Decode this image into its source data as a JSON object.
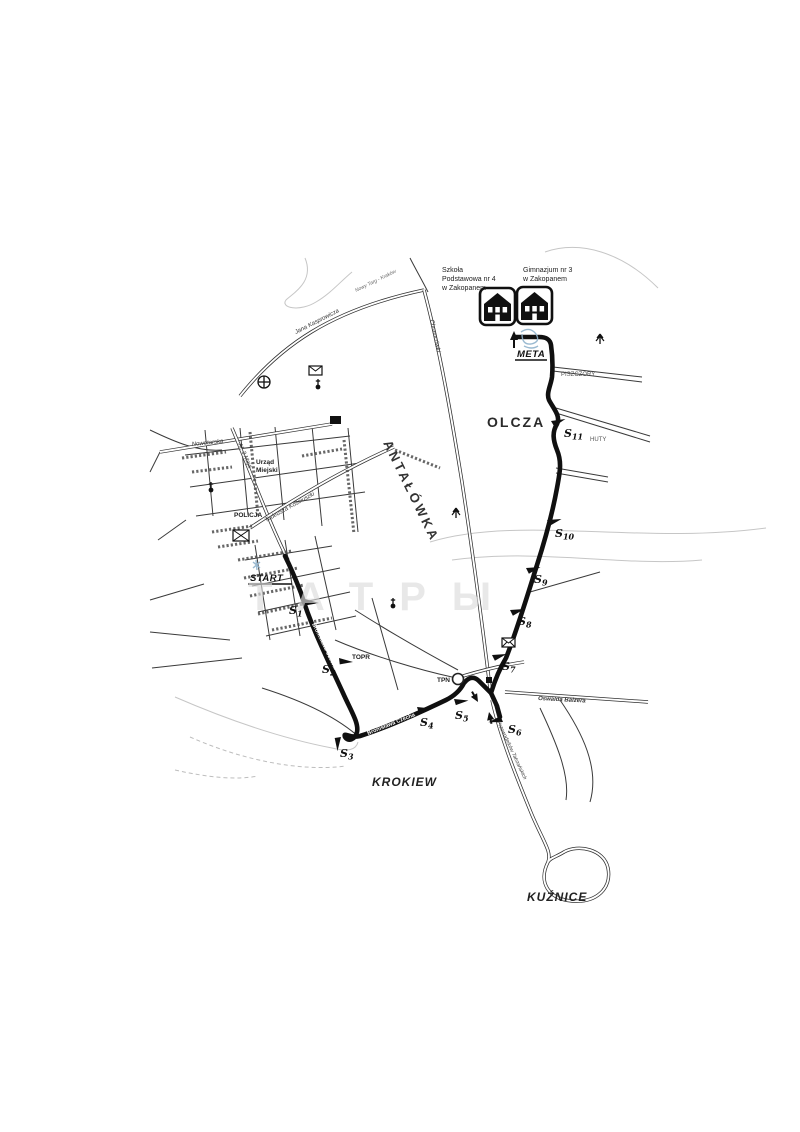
{
  "watermark": {
    "text": "ТАТРЫ"
  },
  "schools": {
    "left": [
      "Szkoła",
      "Podstawowa nr 4",
      "w Zakopanem"
    ],
    "right": [
      "Gimnazjum nr 3",
      "w Zakopanem"
    ]
  },
  "route": {
    "start": "START",
    "meta": "META",
    "checkpoints": [
      {
        "s": "S",
        "n": "1"
      },
      {
        "s": "S",
        "n": "2"
      },
      {
        "s": "S",
        "n": "3"
      },
      {
        "s": "S",
        "n": "4"
      },
      {
        "s": "S",
        "n": "5"
      },
      {
        "s": "S",
        "n": "6"
      },
      {
        "s": "S",
        "n": "7"
      },
      {
        "s": "S",
        "n": "8"
      },
      {
        "s": "S",
        "n": "9"
      },
      {
        "s": "S",
        "n": "10"
      },
      {
        "s": "S",
        "n": "11"
      }
    ]
  },
  "areas": {
    "olcza": "OLCZA",
    "antalowka": "ANTAŁÓWKA",
    "krokiew": "KROKIEW",
    "kuznice": "KUŹNICE"
  },
  "places": {
    "urzad_line1": "Urząd",
    "urzad_line2": "Miejski",
    "policja": "POLICJA",
    "topr": "TOPR",
    "tpn": "TPN",
    "piszczory": "PISZCZORY",
    "huty": "HUTY"
  },
  "streets": {
    "kasprowicza": "Jana Kasprowicza",
    "nowytarg": "Nowy Targ - Kraków",
    "nowotarska": "Nowotarska",
    "chramcowki": "Chramcówki",
    "al3maja": "Al. 3 Maja",
    "kosciuszki": "Tadeusza Kościuszki",
    "balzera": "Oswalda Balzera",
    "czecha_upper": "Bronisława Czecha",
    "czecha_lower": "Bronisława Czecha",
    "przewodnikow": "Przewodników Tatrzańskich"
  }
}
